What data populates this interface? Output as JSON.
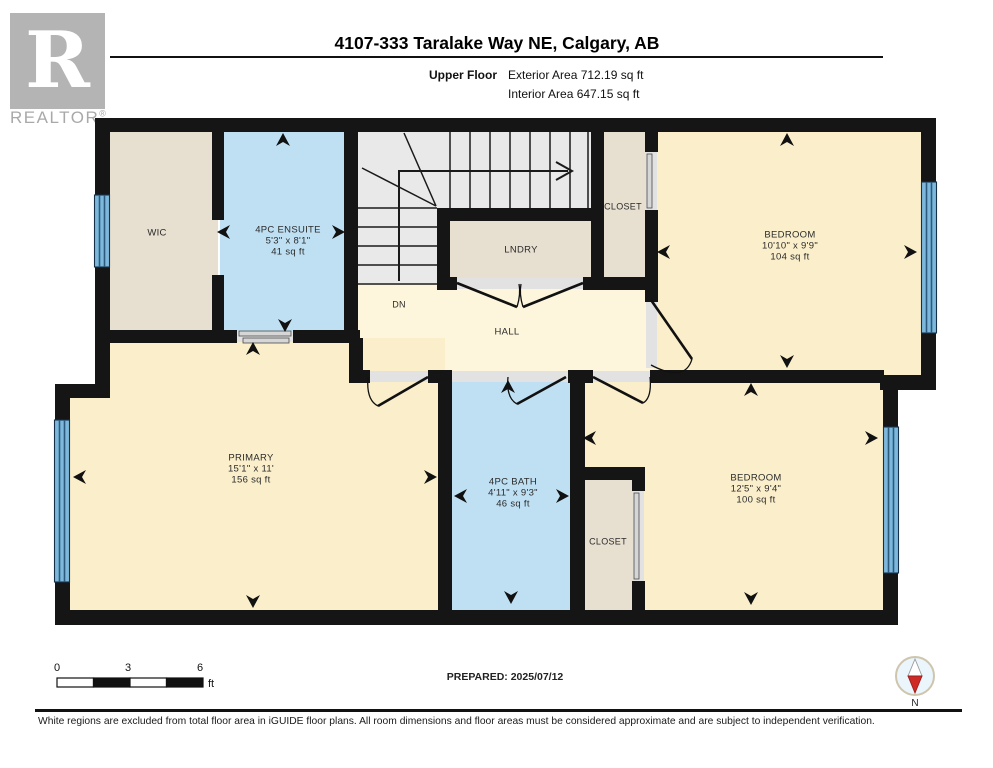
{
  "header": {
    "logo": {
      "letter": "R",
      "brand": "REALTOR",
      "registered": "®"
    },
    "title": "4107-333 Taralake Way NE, Calgary, AB",
    "floor_label": "Upper Floor",
    "exterior_area": "Exterior Area 712.19 sq ft",
    "interior_area": "Interior Area 647.15 sq ft"
  },
  "rooms": {
    "wic": {
      "name": "WIC"
    },
    "ensuite": {
      "name": "4PC ENSUITE",
      "dims": "5'3\" x 8'1\"",
      "area": "41 sq ft"
    },
    "closet_top": {
      "name": "CLOSET"
    },
    "lndry": {
      "name": "LNDRY"
    },
    "bedroom_top": {
      "name": "BEDROOM",
      "dims": "10'10\" x 9'9\"",
      "area": "104 sq ft"
    },
    "stairs": {
      "down_label": "DN"
    },
    "hall": {
      "name": "HALL"
    },
    "primary": {
      "name": "PRIMARY",
      "dims": "15'1\" x 11'",
      "area": "156 sq ft"
    },
    "bath": {
      "name": "4PC BATH",
      "dims": "4'11\" x 9'3\"",
      "area": "46 sq ft"
    },
    "closet_bottom": {
      "name": "CLOSET"
    },
    "bedroom_bottom": {
      "name": "BEDROOM",
      "dims": "12'5\" x 9'4\"",
      "area": "100 sq ft"
    }
  },
  "footer": {
    "scale": {
      "ticks": [
        "0",
        "3",
        "6"
      ],
      "unit": "ft"
    },
    "prepared": "PREPARED: 2025/07/12",
    "compass_label": "N",
    "disclaimer": "White regions are excluded from total floor area in iGUIDE floor plans. All room dimensions and floor areas must be considered approximate and are subject to independent verification."
  },
  "colors": {
    "wall": "#151515",
    "room_tan": "#e7dfd0",
    "room_blue": "#bfe0f3",
    "room_yellow": "#faeecb",
    "hall_yellow": "#fdf6dc",
    "stairs_gray": "#e9e9e9",
    "window_blue": "#7db8dc",
    "compass_red": "#cf2b26"
  }
}
